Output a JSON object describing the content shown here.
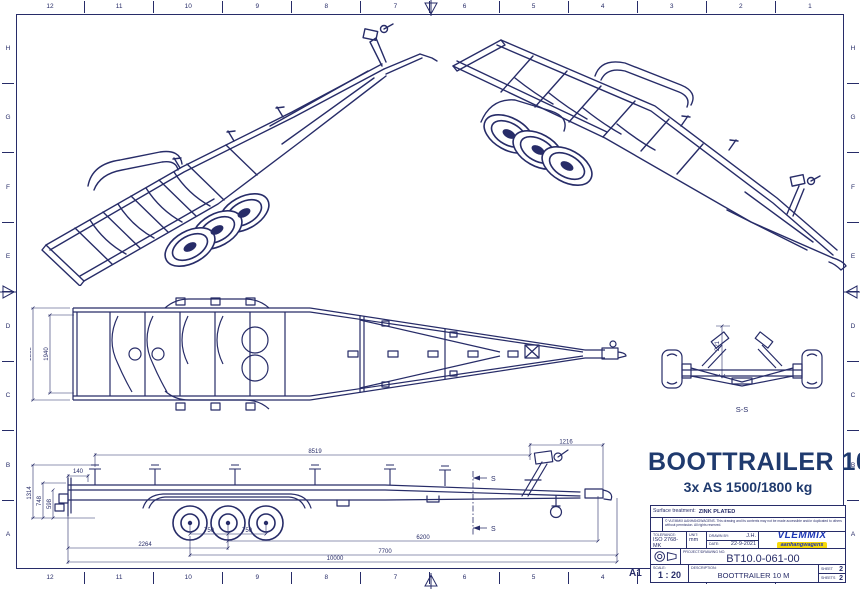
{
  "sheet": {
    "format_label": "A1",
    "grid_cols": [
      "12",
      "11",
      "10",
      "9",
      "8",
      "7",
      "6",
      "5",
      "4",
      "3",
      "2",
      "1"
    ],
    "grid_rows": [
      "H",
      "G",
      "F",
      "E",
      "D",
      "C",
      "B",
      "A"
    ]
  },
  "title": {
    "main": "BOOTTRAILER 1000",
    "subtitle": "3x AS 1500/1800 kg"
  },
  "title_block": {
    "surface_label": "Surface treatment:",
    "surface_value": "ZINK PLATED",
    "copyright_line1": "© VLEMMIX AANHANGWAGENS.",
    "copyright_line2": "This drawing and its contents may not be made accessible and/or duplicated to others without permission. All rights reserved.",
    "tolerance_label": "TOLERANCE:",
    "tolerance_value": "ISO 2768-MK",
    "unit_label": "UNIT:",
    "unit_value": "mm",
    "drawn_label": "DRAWN BY:",
    "drawn_value": "J.H.",
    "date_label": "DATE:",
    "date_value": "22-9-2021",
    "drawing_no_label": "PROJECT/DRAWING NO.",
    "drawing_no_value": "BT10.0-061-00",
    "scale_label": "SCALE:",
    "scale_value": "1 : 20",
    "description_label": "DESCRIPTION:",
    "description_value": "BOOTTRAILER 10 M",
    "sheet_label": "SHEET",
    "sheet_value": "2",
    "sheets_label": "SHEETS",
    "sheets_value": "2",
    "logo_text": "VLEMMIX",
    "logo_sub": "aanhangwagens"
  },
  "views": {
    "section_view_label": "S-S",
    "section_cut_label": "S"
  },
  "dims": {
    "plan": {
      "overall_width": "2368",
      "frame_width": "1940"
    },
    "side": {
      "top_length": "8519",
      "front_overhang": "1216",
      "rear_offset": "140",
      "height_overall": "1314",
      "height_frame": "748",
      "height_rail": "598",
      "rear_to_first_axle": "2264",
      "axle_spacing_a": "750",
      "axle_spacing_b": "750",
      "axle_to_coupling": "6200",
      "mid_length": "7700",
      "overall_length": "10000"
    },
    "section": {
      "keel_height": "221"
    }
  },
  "colors": {
    "line_ink": "#272c68",
    "title_navy": "#1f3a6e",
    "logo_blue": "#1d36b5",
    "logo_yellow": "#f6d90a"
  }
}
